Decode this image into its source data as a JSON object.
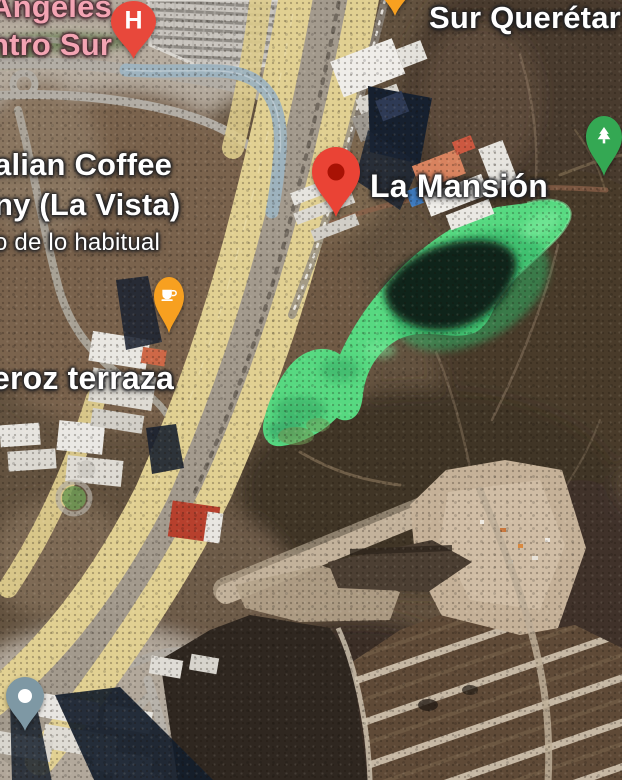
{
  "labels": {
    "hospital": {
      "line1": "Ángeles",
      "line2": "ntro Sur"
    },
    "street_top_right": "Sur Querétar",
    "coffee_shop": {
      "line1": "alian Coffee",
      "line2": "ny (La Vista)",
      "subtitle": "o de lo habitual"
    },
    "la_mansion": "La Mansión",
    "terraza": "eroz terraza"
  },
  "pins": {
    "hospital": {
      "glyph": "H",
      "color": "#e8483b",
      "icon": "hospital-pin"
    },
    "la_mansion": {
      "color": "#ea4335",
      "inner": "#a81205",
      "icon": "red-place-pin"
    },
    "coffee": {
      "color": "#f7a020",
      "icon": "coffee-cup-icon"
    },
    "park": {
      "color": "#34a853",
      "icon": "pine-tree-icon"
    },
    "generic": {
      "color": "#7e98a4",
      "icon": "dot-pin"
    },
    "top_orange": {
      "color": "#f7a020",
      "icon": "orange-poi-pin"
    }
  },
  "colors": {
    "highway": "#e1d092",
    "lake": "#57d981",
    "hospital_label": "#f3a4b3",
    "label_white": "#ffffff"
  }
}
